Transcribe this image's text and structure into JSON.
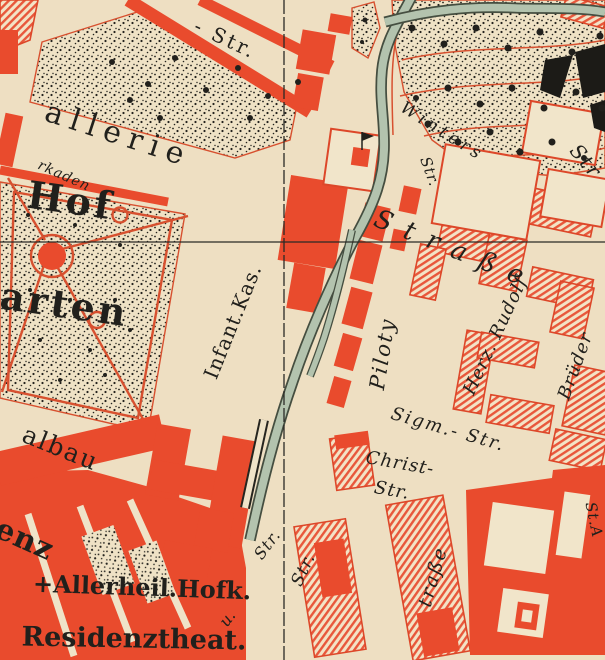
{
  "map": {
    "title": "Historic city map detail (Hofgarten / Residenz quarter)",
    "colors": {
      "building_red": "#e94b2d",
      "hatch_red": "#e8573b",
      "outline_red": "#dd4729",
      "paper": "#eedfc2",
      "paper_light": "#f1e5ca",
      "stream_green": "#b3c3ae",
      "stream_edge": "#454e40",
      "ink": "#21201c",
      "label_red": "#d93c22",
      "path_red": "#d7502f"
    },
    "labels": [
      {
        "id": "top-street",
        "text": "- Str.",
        "x": 225,
        "y": 40,
        "rot": 25,
        "size": 20,
        "italic": false,
        "bold": false,
        "ls": 3
      },
      {
        "id": "gallerie",
        "text": "allerie",
        "x": 118,
        "y": 136,
        "rot": 18,
        "size": 30,
        "italic": false,
        "bold": false,
        "ls": 8
      },
      {
        "id": "arkaden",
        "text": "rkaden",
        "x": 64,
        "y": 176,
        "rot": 24,
        "size": 14,
        "italic": true,
        "bold": false,
        "ls": 1,
        "color": "#d93c22"
      },
      {
        "id": "hof",
        "text": "Hof",
        "x": 70,
        "y": 204,
        "rot": 8,
        "size": 38,
        "italic": false,
        "bold": true,
        "ls": 3
      },
      {
        "id": "garten",
        "text": "arten",
        "x": 64,
        "y": 308,
        "rot": 8,
        "size": 38,
        "italic": false,
        "bold": true,
        "ls": 3
      },
      {
        "id": "infant-kas",
        "text": "Infant.Kas.",
        "x": 234,
        "y": 322,
        "rot": -68,
        "size": 20,
        "italic": false,
        "bold": false,
        "ls": 1
      },
      {
        "id": "winters",
        "text": "Winters",
        "x": 442,
        "y": 132,
        "rot": 32,
        "size": 17,
        "italic": true,
        "bold": false,
        "ls": 4
      },
      {
        "id": "winters-str",
        "text": "Str",
        "x": 585,
        "y": 162,
        "rot": 50,
        "size": 20,
        "italic": true,
        "bold": false,
        "ls": 2
      },
      {
        "id": "str-vert-top",
        "text": "Str.",
        "x": 429,
        "y": 172,
        "rot": 70,
        "size": 15,
        "italic": true,
        "bold": false,
        "ls": 1
      },
      {
        "id": "strasse-big",
        "text": "Straße",
        "x": 455,
        "y": 251,
        "rot": 22,
        "size": 26,
        "italic": true,
        "bold": false,
        "ls": 14
      },
      {
        "id": "piloty",
        "text": "Piloty",
        "x": 384,
        "y": 354,
        "rot": -81,
        "size": 21,
        "italic": true,
        "bold": false,
        "ls": 2
      },
      {
        "id": "herz-rudolf",
        "text": "Herz. Rudolf",
        "x": 496,
        "y": 336,
        "rot": -65,
        "size": 18,
        "italic": true,
        "bold": false,
        "ls": 1
      },
      {
        "id": "brueder",
        "text": "Brüder",
        "x": 576,
        "y": 366,
        "rot": -70,
        "size": 18,
        "italic": true,
        "bold": false,
        "ls": 1
      },
      {
        "id": "sigm-str",
        "text": "Sigm.- Str.",
        "x": 448,
        "y": 430,
        "rot": 16,
        "size": 18,
        "italic": true,
        "bold": false,
        "ls": 2
      },
      {
        "id": "christ",
        "text": "Christ-",
        "x": 400,
        "y": 464,
        "rot": 10,
        "size": 18,
        "italic": true,
        "bold": false,
        "ls": 1
      },
      {
        "id": "christ-str",
        "text": "Str.",
        "x": 392,
        "y": 491,
        "rot": 10,
        "size": 18,
        "italic": true,
        "bold": false,
        "ls": 1
      },
      {
        "id": "str-v1",
        "text": "Str.",
        "x": 268,
        "y": 545,
        "rot": -53,
        "size": 16,
        "italic": true,
        "bold": false,
        "ls": 1
      },
      {
        "id": "u-label",
        "text": "u.",
        "x": 228,
        "y": 619,
        "rot": -53,
        "size": 16,
        "italic": true,
        "bold": false,
        "ls": 0
      },
      {
        "id": "str-v2",
        "text": "Str.",
        "x": 304,
        "y": 570,
        "rot": -65,
        "size": 17,
        "italic": true,
        "bold": false,
        "ls": 1
      },
      {
        "id": "trasse",
        "text": "traße",
        "x": 434,
        "y": 577,
        "rot": -74,
        "size": 19,
        "italic": true,
        "bold": false,
        "ls": 2
      },
      {
        "id": "st-a",
        "text": "St.A",
        "x": 593,
        "y": 520,
        "rot": 78,
        "size": 15,
        "italic": true,
        "bold": false,
        "ls": 1
      },
      {
        "id": "albau",
        "text": "albau",
        "x": 60,
        "y": 450,
        "rot": 22,
        "size": 25,
        "italic": false,
        "bold": false,
        "ls": 2
      },
      {
        "id": "enz",
        "text": "enz",
        "x": 24,
        "y": 541,
        "rot": 24,
        "size": 30,
        "italic": false,
        "bold": true,
        "ls": 1
      },
      {
        "id": "allerheil",
        "text": "+Allerheil.Hofk.",
        "x": 142,
        "y": 589,
        "rot": 2,
        "size": 24,
        "italic": false,
        "bold": true,
        "ls": 0
      },
      {
        "id": "residenztheat",
        "text": "Residenztheat.",
        "x": 134,
        "y": 640,
        "rot": 1,
        "size": 27,
        "italic": false,
        "bold": true,
        "ls": 0
      }
    ]
  }
}
